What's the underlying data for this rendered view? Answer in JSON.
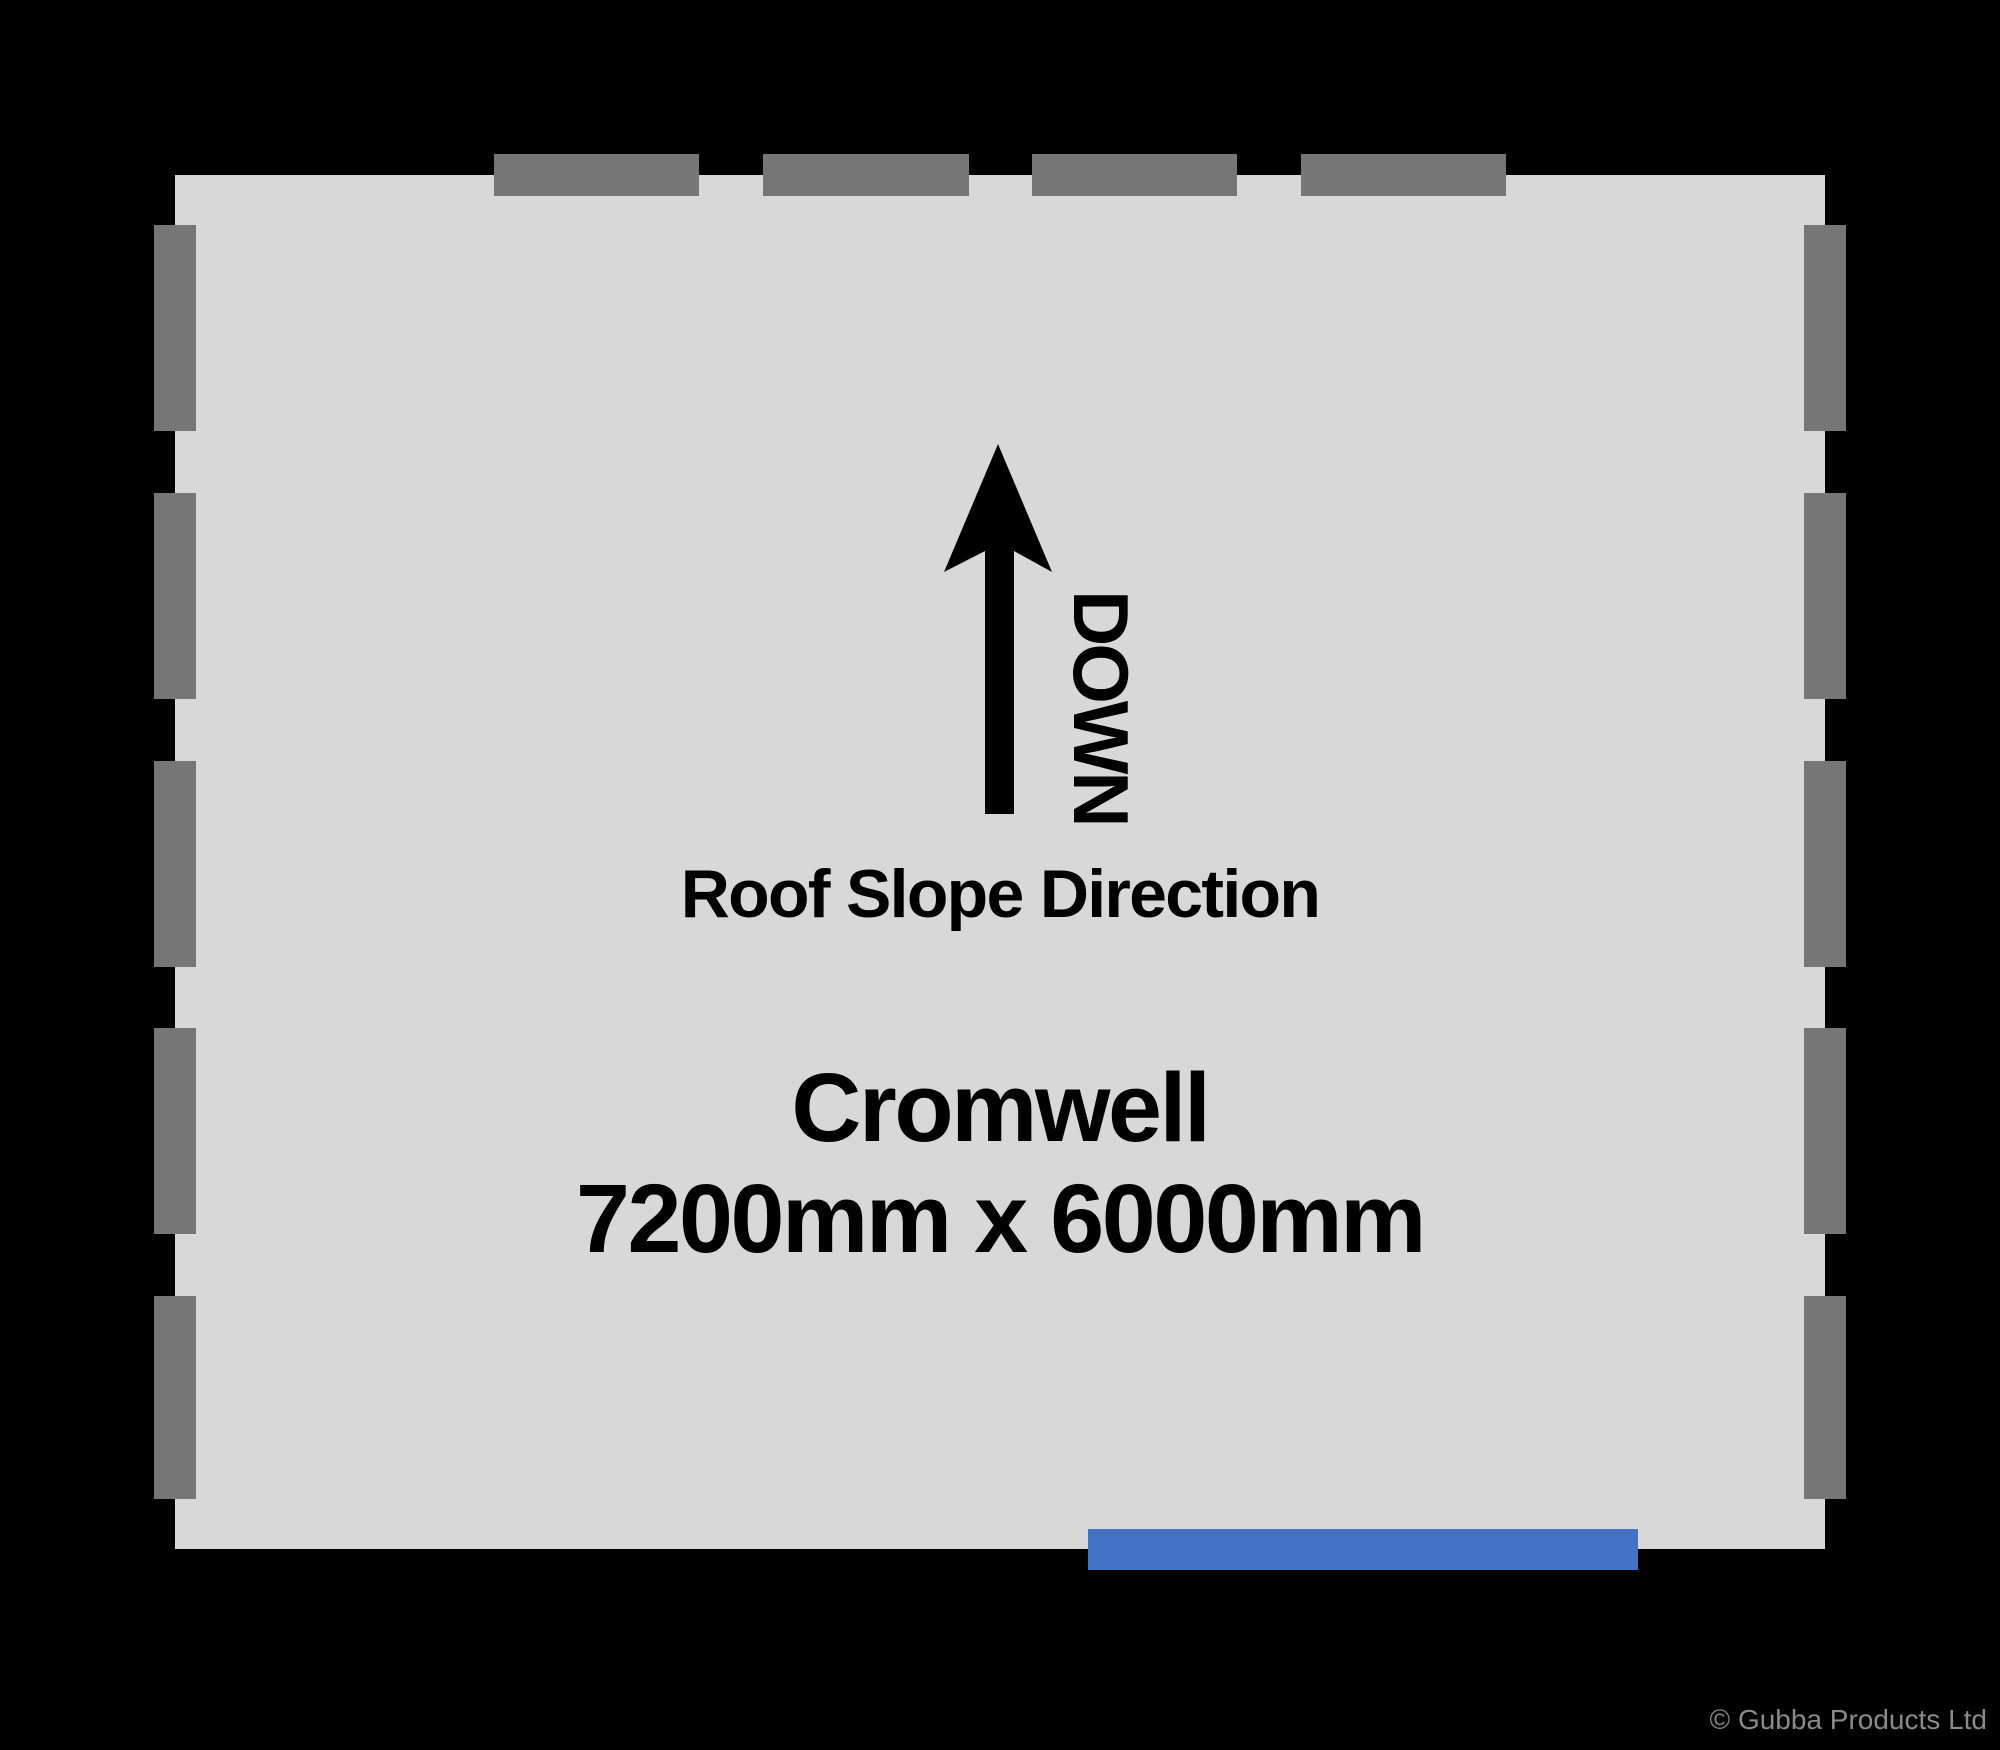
{
  "diagram": {
    "arrow_label": "DOWN",
    "arrow_caption": "Roof Slope Direction",
    "product_name": "Cromwell",
    "product_dimensions": "7200mm x 6000mm"
  },
  "footer": {
    "copyright": "© Gubba Products Ltd"
  },
  "colors": {
    "background": "#000000",
    "floor_fill": "#d8d8d8",
    "wall_dash": "#767676",
    "door_accent": "#4472c4",
    "label_text": "#000000",
    "copyright_text": "#8a8a8a"
  }
}
